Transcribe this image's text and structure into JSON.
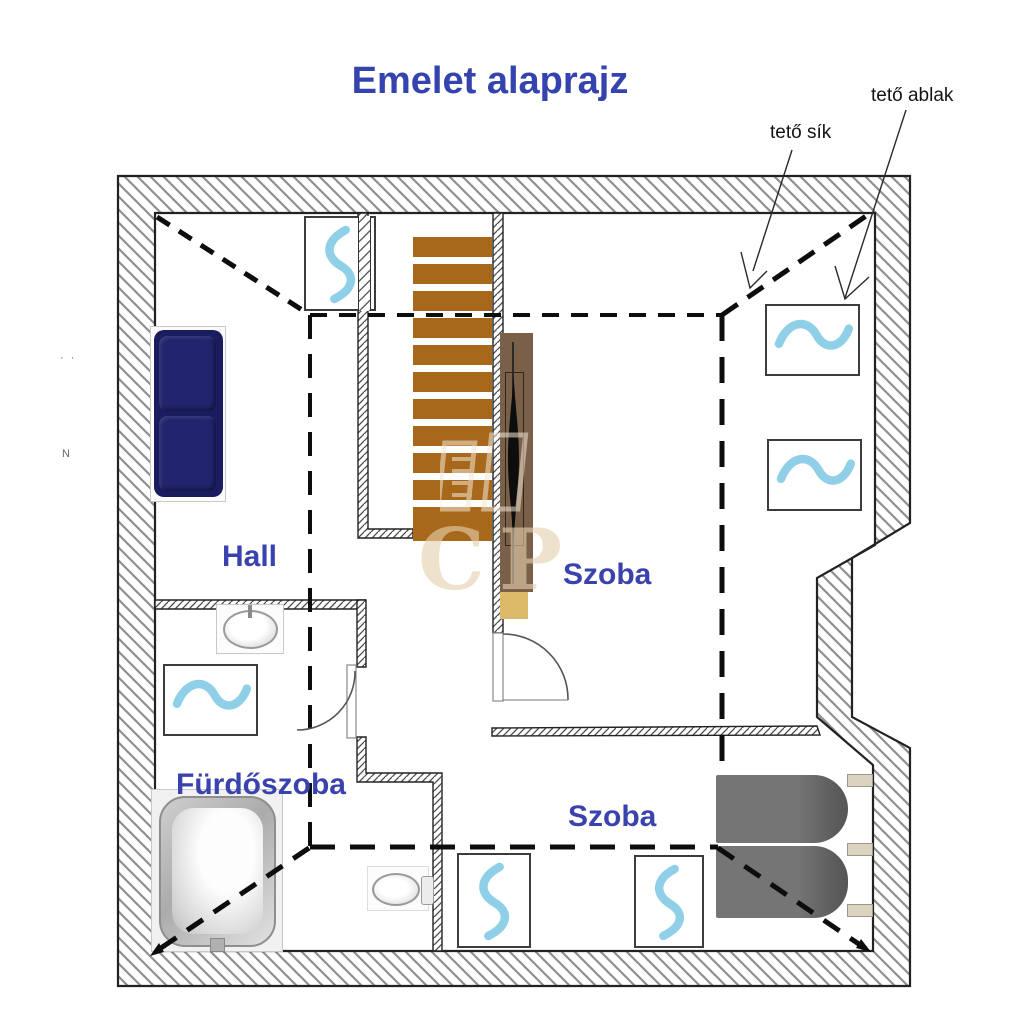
{
  "title": "Emelet alaprajz",
  "annotations": {
    "roof_plane_label": "tető sík",
    "roof_window_label": "tető ablak"
  },
  "rooms": {
    "hall": "Hall",
    "upper_room": "Szoba",
    "lower_room": "Szoba",
    "bathroom": "Fürdőszoba"
  },
  "watermark_text": "CP",
  "margin_marks": {
    "top": "· ·",
    "bottom": "N"
  },
  "stairs": {
    "step_count": 11
  },
  "colors": {
    "label_blue": "#3a43ad",
    "title_blue": "#3443ad",
    "step_brown": "#a8681c",
    "landing_tan": "#ddb96a",
    "sofa_navy": "#1b1c60",
    "bed_gray": "#6f6f6f",
    "wardrobe_brown": "#7a5f49",
    "radiator_wave_blue": "#8fd0e8",
    "wall_hatch_gray": "#909090"
  }
}
